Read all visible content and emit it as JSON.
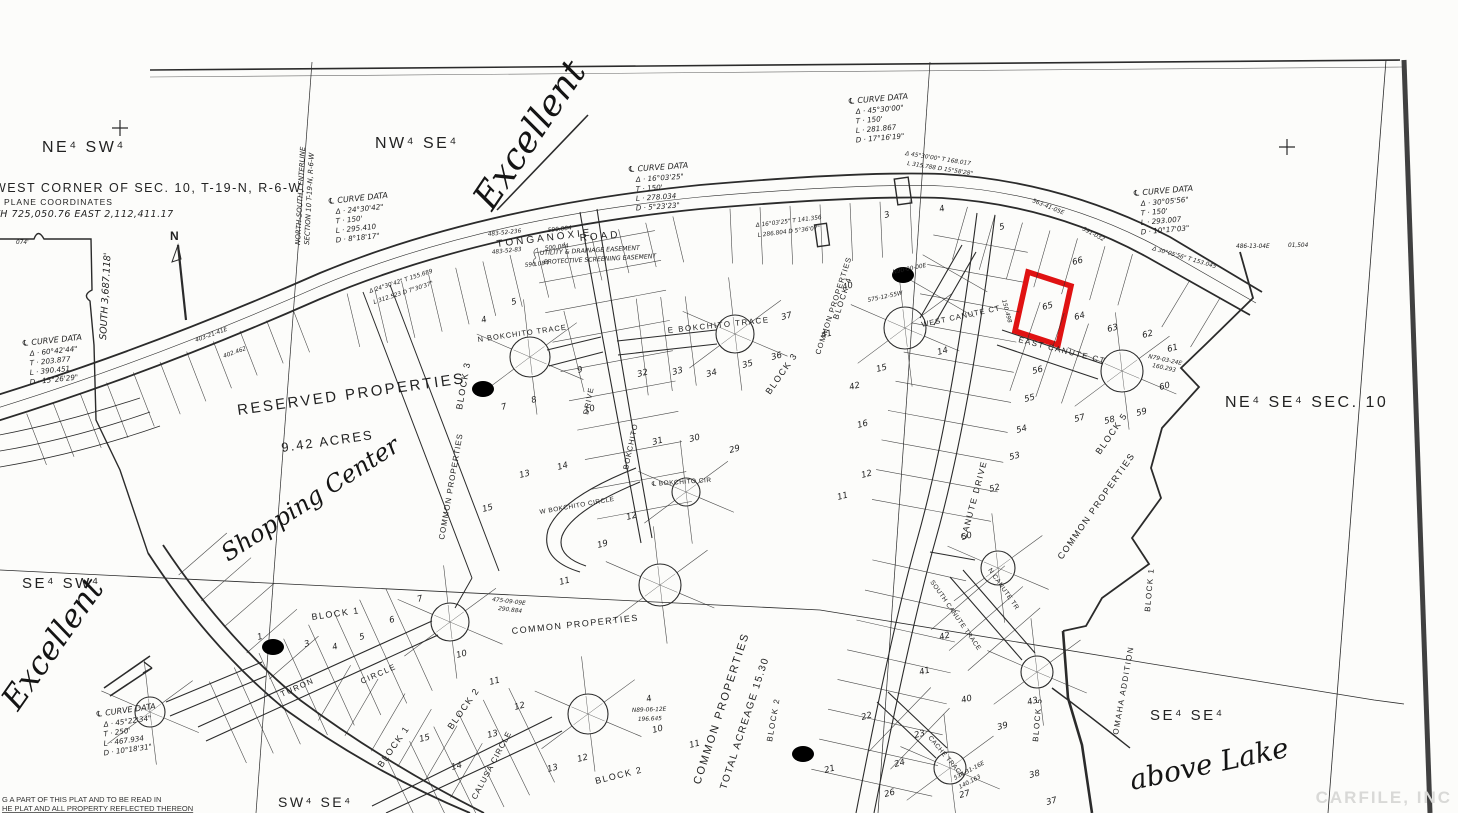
{
  "map": {
    "ink": "#2b2b2b",
    "highlight_color": "#e01212",
    "watermark": "CARFILE, INC",
    "north_arrow": "N",
    "south_dim": "SOUTH 3,687.118'",
    "easement_1": "UTILITY & DRAINAGE EASEMENT",
    "easement_2": "PROTECTIVE SCREENING EASEMENT",
    "footer_line_1": "G A PART OF THIS PLAT  AND TO BE  READ  IN",
    "footer_line_2": "HE PLAT AND ALL PROPERTY REFLECTED THEREON",
    "corner_note": {
      "line1": "WEST CORNER OF SEC. 10, T-19-N, R-6-W.",
      "line2": "E PLANE  COORDINATES",
      "line3": "TH 725,050.76    EAST 2,112,411.17"
    },
    "centerline_label_1": "NORTH-SOUTH CENTERLINE",
    "centerline_label_2": "SECTION 10  T-19-N, R-6-W",
    "sections": [
      {
        "t": "NE⁴ SW⁴",
        "x": 42,
        "y": 152,
        "s": 16
      },
      {
        "t": "NW⁴ SE⁴",
        "x": 375,
        "y": 148,
        "s": 16
      },
      {
        "t": "NE⁴ SE⁴ SEC. 10",
        "x": 1225,
        "y": 407,
        "s": 16
      },
      {
        "t": "SE⁴ SW⁴",
        "x": 22,
        "y": 588,
        "s": 15
      },
      {
        "t": "SW⁴ SE⁴",
        "x": 278,
        "y": 807,
        "s": 14
      },
      {
        "t": "SE⁴ SE⁴",
        "x": 1150,
        "y": 720,
        "s": 15
      }
    ],
    "curve_tables": [
      {
        "x": 628,
        "y": 172,
        "r": -4,
        "title": "℄ CURVE DATA",
        "rows": [
          "Δ · 16°03'25\"",
          "T · 150'",
          "L · 278.034",
          "D · 5°23'23\""
        ]
      },
      {
        "x": 328,
        "y": 204,
        "r": -6,
        "title": "℄ CURVE DATA",
        "rows": [
          "Δ · 24°30'42\"",
          "T · 150'",
          "L · 295.410",
          "D · 8°18'17\""
        ]
      },
      {
        "x": 848,
        "y": 104,
        "r": -5,
        "title": "℄ CURVE DATA",
        "rows": [
          "Δ · 45°30'00\"",
          "T · 150'",
          "L · 281.867",
          "D · 17°16'19\""
        ]
      },
      {
        "x": 1133,
        "y": 196,
        "r": -5,
        "title": "℄ CURVE DATA",
        "rows": [
          "Δ · 30°05'56\"",
          "T · 150'",
          "L · 293.007",
          "D · 10°17'03\""
        ]
      },
      {
        "x": 22,
        "y": 346,
        "r": -6,
        "title": "℄ CURVE DATA",
        "rows": [
          "Δ · 60°42'44\"",
          "T · 203.877",
          "L · 390.451",
          "D · 15°26'29\""
        ]
      },
      {
        "x": 96,
        "y": 717,
        "r": -8,
        "title": "℄ CURVE DATA",
        "rows": [
          "Δ · 45°22'34\"",
          "T · 250'",
          "L · 467.934",
          "D · 10°18'31\""
        ]
      }
    ],
    "streets": [
      {
        "t": "TONGANOXIE",
        "x": 497,
        "y": 247,
        "r": -7,
        "s": 10,
        "ls": 3
      },
      {
        "t": "ROAD",
        "x": 580,
        "y": 241,
        "r": -5,
        "s": 10,
        "ls": 3
      },
      {
        "t": "N  BOKCHITO  TRACE",
        "x": 478,
        "y": 342,
        "r": -8,
        "s": 7.5,
        "ls": 1
      },
      {
        "t": "E  BOKCHITO  TRACE",
        "x": 668,
        "y": 333,
        "r": -6,
        "s": 8,
        "ls": 1.5
      },
      {
        "t": "BOKCHITO",
        "x": 628,
        "y": 470,
        "r": -78,
        "s": 7.5,
        "ls": 1
      },
      {
        "t": "DRIVE",
        "x": 588,
        "y": 415,
        "r": -78,
        "s": 7.5,
        "ls": 1
      },
      {
        "t": "℄ BOKCHITO CIR",
        "x": 652,
        "y": 486,
        "r": -4,
        "s": 6.5,
        "ls": 0.5
      },
      {
        "t": "W BOKCHITO CIRCLE",
        "x": 540,
        "y": 514,
        "r": -10,
        "s": 6.5,
        "ls": 0.5
      },
      {
        "t": "TURON",
        "x": 282,
        "y": 697,
        "r": -24,
        "s": 8,
        "ls": 1.5
      },
      {
        "t": "CIRCLE",
        "x": 362,
        "y": 684,
        "r": -24,
        "s": 8,
        "ls": 1.5
      },
      {
        "t": "CALUSA CIRCLE",
        "x": 476,
        "y": 800,
        "r": -62,
        "s": 8,
        "ls": 1
      },
      {
        "t": "WEST CANUTE CT",
        "x": 922,
        "y": 327,
        "r": -12,
        "s": 7.5,
        "ls": 1
      },
      {
        "t": "EAST CANUTE CT",
        "x": 1018,
        "y": 342,
        "r": 14,
        "s": 8,
        "ls": 1.5
      },
      {
        "t": "CANUTE  DRIVE",
        "x": 966,
        "y": 540,
        "r": -75,
        "s": 8.5,
        "ls": 1.5
      },
      {
        "t": "SOUTH CANUTE TRACE",
        "x": 930,
        "y": 582,
        "r": 55,
        "s": 6.5,
        "ls": 0.5
      },
      {
        "t": "N CANUTE TR",
        "x": 988,
        "y": 570,
        "r": 55,
        "s": 6.5,
        "ls": 0.5
      },
      {
        "t": "CACHE TRACE",
        "x": 928,
        "y": 738,
        "r": 50,
        "s": 6.5,
        "ls": 0.5
      }
    ],
    "areas": [
      {
        "t": "RESERVED PROPERTIES",
        "x": 238,
        "y": 415,
        "r": -8,
        "s": 15,
        "ls": 2.5
      },
      {
        "t": "9.42 ACRES",
        "x": 282,
        "y": 452,
        "r": -8,
        "s": 13,
        "ls": 2
      },
      {
        "t": "COMMON PROPERTIES",
        "x": 444,
        "y": 540,
        "r": -80,
        "s": 8,
        "ls": 1
      },
      {
        "t": "COMMON PROPERTIES",
        "x": 820,
        "y": 355,
        "r": -72,
        "s": 7.5,
        "ls": 1
      },
      {
        "t": "COMMON PROPERTIES",
        "x": 1062,
        "y": 560,
        "r": -55,
        "s": 9,
        "ls": 1.5
      },
      {
        "t": "COMMON PROPERTIES",
        "x": 512,
        "y": 634,
        "r": -6,
        "s": 9,
        "ls": 1.5
      },
      {
        "t": "COMMON PROPERTIES",
        "x": 700,
        "y": 785,
        "r": -72,
        "s": 11,
        "ls": 2
      },
      {
        "t": "TOTAL ACREAGE 15.30",
        "x": 726,
        "y": 790,
        "r": -72,
        "s": 10,
        "ls": 1.5
      },
      {
        "t": "OMAHA  ADDITION",
        "x": 1118,
        "y": 735,
        "r": -80,
        "s": 8,
        "ls": 1.5
      }
    ],
    "blocks": [
      {
        "t": "BLOCK 3",
        "x": 462,
        "y": 410,
        "r": -80,
        "s": 9
      },
      {
        "t": "BLOCK 3",
        "x": 770,
        "y": 395,
        "r": -55,
        "s": 9
      },
      {
        "t": "BLOCK 1",
        "x": 312,
        "y": 620,
        "r": -8,
        "s": 9
      },
      {
        "t": "BLOCK 1",
        "x": 382,
        "y": 768,
        "r": -55,
        "s": 9
      },
      {
        "t": "BLOCK 1",
        "x": 1150,
        "y": 612,
        "r": -85,
        "s": 8
      },
      {
        "t": "BLOCK 2",
        "x": 452,
        "y": 730,
        "r": -55,
        "s": 9
      },
      {
        "t": "BLOCK 2",
        "x": 596,
        "y": 784,
        "r": -14,
        "s": 9
      },
      {
        "t": "BLOCK 2",
        "x": 772,
        "y": 742,
        "r": -80,
        "s": 8
      },
      {
        "t": "BLOCK 4",
        "x": 838,
        "y": 320,
        "r": -72,
        "s": 8
      },
      {
        "t": "BLOCK 5",
        "x": 1100,
        "y": 455,
        "r": -55,
        "s": 9
      },
      {
        "t": "BLOCK 5",
        "x": 1038,
        "y": 742,
        "r": -85,
        "s": 8
      }
    ],
    "handwritten": [
      {
        "t": "Excellent",
        "x": 492,
        "y": 212,
        "r": -56,
        "s": 36
      },
      {
        "t": "Excellent",
        "x": 18,
        "y": 712,
        "r": -55,
        "s": 32
      },
      {
        "t": "Shopping Center",
        "x": 228,
        "y": 562,
        "r": -33,
        "s": 24
      },
      {
        "t": "above Lake",
        "x": 1132,
        "y": 790,
        "r": -12,
        "s": 28
      }
    ],
    "lots": [
      {
        "n": "4",
        "x": 482,
        "y": 323
      },
      {
        "n": "5",
        "x": 512,
        "y": 305
      },
      {
        "n": "6",
        "x": 480,
        "y": 392,
        "c": 1
      },
      {
        "n": "7",
        "x": 502,
        "y": 410
      },
      {
        "n": "8",
        "x": 532,
        "y": 403
      },
      {
        "n": "9",
        "x": 578,
        "y": 373
      },
      {
        "n": "10",
        "x": 585,
        "y": 413
      },
      {
        "n": "32",
        "x": 638,
        "y": 377
      },
      {
        "n": "33",
        "x": 673,
        "y": 375
      },
      {
        "n": "34",
        "x": 707,
        "y": 377
      },
      {
        "n": "35",
        "x": 743,
        "y": 368
      },
      {
        "n": "36",
        "x": 772,
        "y": 360
      },
      {
        "n": "37",
        "x": 782,
        "y": 320
      },
      {
        "n": "31",
        "x": 653,
        "y": 445
      },
      {
        "n": "30",
        "x": 690,
        "y": 442
      },
      {
        "n": "29",
        "x": 730,
        "y": 453
      },
      {
        "n": "3",
        "x": 885,
        "y": 218
      },
      {
        "n": "4",
        "x": 940,
        "y": 212
      },
      {
        "n": "5",
        "x": 1000,
        "y": 230
      },
      {
        "n": "6",
        "x": 900,
        "y": 278,
        "c": 1
      },
      {
        "n": "13",
        "x": 520,
        "y": 478
      },
      {
        "n": "14",
        "x": 558,
        "y": 470
      },
      {
        "n": "15",
        "x": 483,
        "y": 512
      },
      {
        "n": "19",
        "x": 598,
        "y": 548
      },
      {
        "n": "12",
        "x": 627,
        "y": 520
      },
      {
        "n": "11",
        "x": 560,
        "y": 585
      },
      {
        "n": "40",
        "x": 843,
        "y": 290
      },
      {
        "n": "41",
        "x": 822,
        "y": 338
      },
      {
        "n": "42",
        "x": 850,
        "y": 390
      },
      {
        "n": "15",
        "x": 877,
        "y": 372
      },
      {
        "n": "14",
        "x": 938,
        "y": 355
      },
      {
        "n": "16",
        "x": 858,
        "y": 428
      },
      {
        "n": "12",
        "x": 862,
        "y": 478
      },
      {
        "n": "11",
        "x": 838,
        "y": 500
      },
      {
        "n": "66",
        "x": 1073,
        "y": 265
      },
      {
        "n": "65",
        "x": 1043,
        "y": 310
      },
      {
        "n": "64",
        "x": 1075,
        "y": 320
      },
      {
        "n": "63",
        "x": 1108,
        "y": 332
      },
      {
        "n": "62",
        "x": 1143,
        "y": 338
      },
      {
        "n": "61",
        "x": 1168,
        "y": 352
      },
      {
        "n": "60",
        "x": 1160,
        "y": 390
      },
      {
        "n": "56",
        "x": 1033,
        "y": 374
      },
      {
        "n": "55",
        "x": 1025,
        "y": 402
      },
      {
        "n": "54",
        "x": 1017,
        "y": 433
      },
      {
        "n": "53",
        "x": 1010,
        "y": 460
      },
      {
        "n": "52",
        "x": 990,
        "y": 492
      },
      {
        "n": "50",
        "x": 962,
        "y": 540
      },
      {
        "n": "57",
        "x": 1075,
        "y": 422
      },
      {
        "n": "58",
        "x": 1105,
        "y": 424
      },
      {
        "n": "59",
        "x": 1137,
        "y": 416
      },
      {
        "n": "1",
        "x": 258,
        "y": 640
      },
      {
        "n": "2",
        "x": 270,
        "y": 650,
        "c": 1
      },
      {
        "n": "3",
        "x": 305,
        "y": 647
      },
      {
        "n": "4",
        "x": 333,
        "y": 650
      },
      {
        "n": "5",
        "x": 360,
        "y": 640
      },
      {
        "n": "6",
        "x": 390,
        "y": 623
      },
      {
        "n": "7",
        "x": 418,
        "y": 602
      },
      {
        "n": "10",
        "x": 457,
        "y": 658
      },
      {
        "n": "11",
        "x": 490,
        "y": 685
      },
      {
        "n": "12",
        "x": 515,
        "y": 710
      },
      {
        "n": "13",
        "x": 488,
        "y": 738
      },
      {
        "n": "14",
        "x": 452,
        "y": 770
      },
      {
        "n": "15",
        "x": 420,
        "y": 742
      },
      {
        "n": "4",
        "x": 647,
        "y": 702
      },
      {
        "n": "10",
        "x": 653,
        "y": 733
      },
      {
        "n": "11",
        "x": 690,
        "y": 748
      },
      {
        "n": "12",
        "x": 578,
        "y": 762
      },
      {
        "n": "13",
        "x": 548,
        "y": 772
      },
      {
        "n": "20",
        "x": 800,
        "y": 757,
        "c": 1
      },
      {
        "n": "21",
        "x": 825,
        "y": 773
      },
      {
        "n": "22",
        "x": 862,
        "y": 720
      },
      {
        "n": "23",
        "x": 915,
        "y": 738
      },
      {
        "n": "24",
        "x": 895,
        "y": 767
      },
      {
        "n": "26",
        "x": 885,
        "y": 797
      },
      {
        "n": "27",
        "x": 960,
        "y": 798
      },
      {
        "n": "38",
        "x": 1030,
        "y": 778
      },
      {
        "n": "39",
        "x": 998,
        "y": 730
      },
      {
        "n": "40",
        "x": 962,
        "y": 703
      },
      {
        "n": "41",
        "x": 920,
        "y": 675
      },
      {
        "n": "42",
        "x": 940,
        "y": 640
      },
      {
        "n": "43",
        "x": 1028,
        "y": 705
      },
      {
        "n": "37",
        "x": 1047,
        "y": 805
      }
    ],
    "dims": [
      {
        "t": "074'",
        "x": 16,
        "y": 244,
        "r": 0
      },
      {
        "t": "483-52-236",
        "x": 488,
        "y": 236,
        "r": -6
      },
      {
        "t": "590.084",
        "x": 548,
        "y": 232,
        "r": -6
      },
      {
        "t": "483-52-83",
        "x": 492,
        "y": 254,
        "r": -6
      },
      {
        "t": "500.084",
        "x": 545,
        "y": 250,
        "r": -6
      },
      {
        "t": "590.084",
        "x": 525,
        "y": 267,
        "r": -6
      },
      {
        "t": "Δ 24°30'42\" T 155.689",
        "x": 370,
        "y": 293,
        "r": -18
      },
      {
        "t": "L 312.523  D 7°30'37\"",
        "x": 374,
        "y": 304,
        "r": -18
      },
      {
        "t": "Δ 16°03'25\" T 141.356",
        "x": 756,
        "y": 227,
        "r": -7
      },
      {
        "t": "L 286.804  D 5°36'07\"",
        "x": 758,
        "y": 237,
        "r": -7
      },
      {
        "t": "Δ 45°30'00\" T 168.017",
        "x": 905,
        "y": 155,
        "r": 9
      },
      {
        "t": "L 315.788  D 15°58'28\"",
        "x": 907,
        "y": 165,
        "r": 9
      },
      {
        "t": "Δ 30°05'56\" T 153.045",
        "x": 1152,
        "y": 250,
        "r": 16
      },
      {
        "t": "563-41-05E",
        "x": 1032,
        "y": 202,
        "r": 22
      },
      {
        "t": "391-032",
        "x": 1082,
        "y": 230,
        "r": 28
      },
      {
        "t": "486-13-04E",
        "x": 1236,
        "y": 248,
        "r": 0
      },
      {
        "t": "01,504",
        "x": 1288,
        "y": 247,
        "r": 0
      },
      {
        "t": "403-21-41E",
        "x": 196,
        "y": 342,
        "r": -20
      },
      {
        "t": "402.462",
        "x": 224,
        "y": 358,
        "r": -20
      },
      {
        "t": "475-09-09E",
        "x": 492,
        "y": 601,
        "r": 7
      },
      {
        "t": "290.884",
        "x": 498,
        "y": 610,
        "r": 7
      },
      {
        "t": "N89-06-12E",
        "x": 632,
        "y": 712,
        "r": -2
      },
      {
        "t": "196.645",
        "x": 638,
        "y": 721,
        "r": -2
      },
      {
        "t": "N79-03-24E",
        "x": 1148,
        "y": 358,
        "r": 12
      },
      {
        "t": "160.293",
        "x": 1152,
        "y": 367,
        "r": 12
      },
      {
        "t": "574-31-16E",
        "x": 955,
        "y": 780,
        "r": -28
      },
      {
        "t": "140.163",
        "x": 960,
        "y": 789,
        "r": -28
      },
      {
        "t": "575-12-55W",
        "x": 868,
        "y": 302,
        "r": -12
      },
      {
        "t": "N90-00-00E",
        "x": 893,
        "y": 274,
        "r": -12
      },
      {
        "t": "150.498",
        "x": 1002,
        "y": 300,
        "r": 75
      }
    ]
  }
}
